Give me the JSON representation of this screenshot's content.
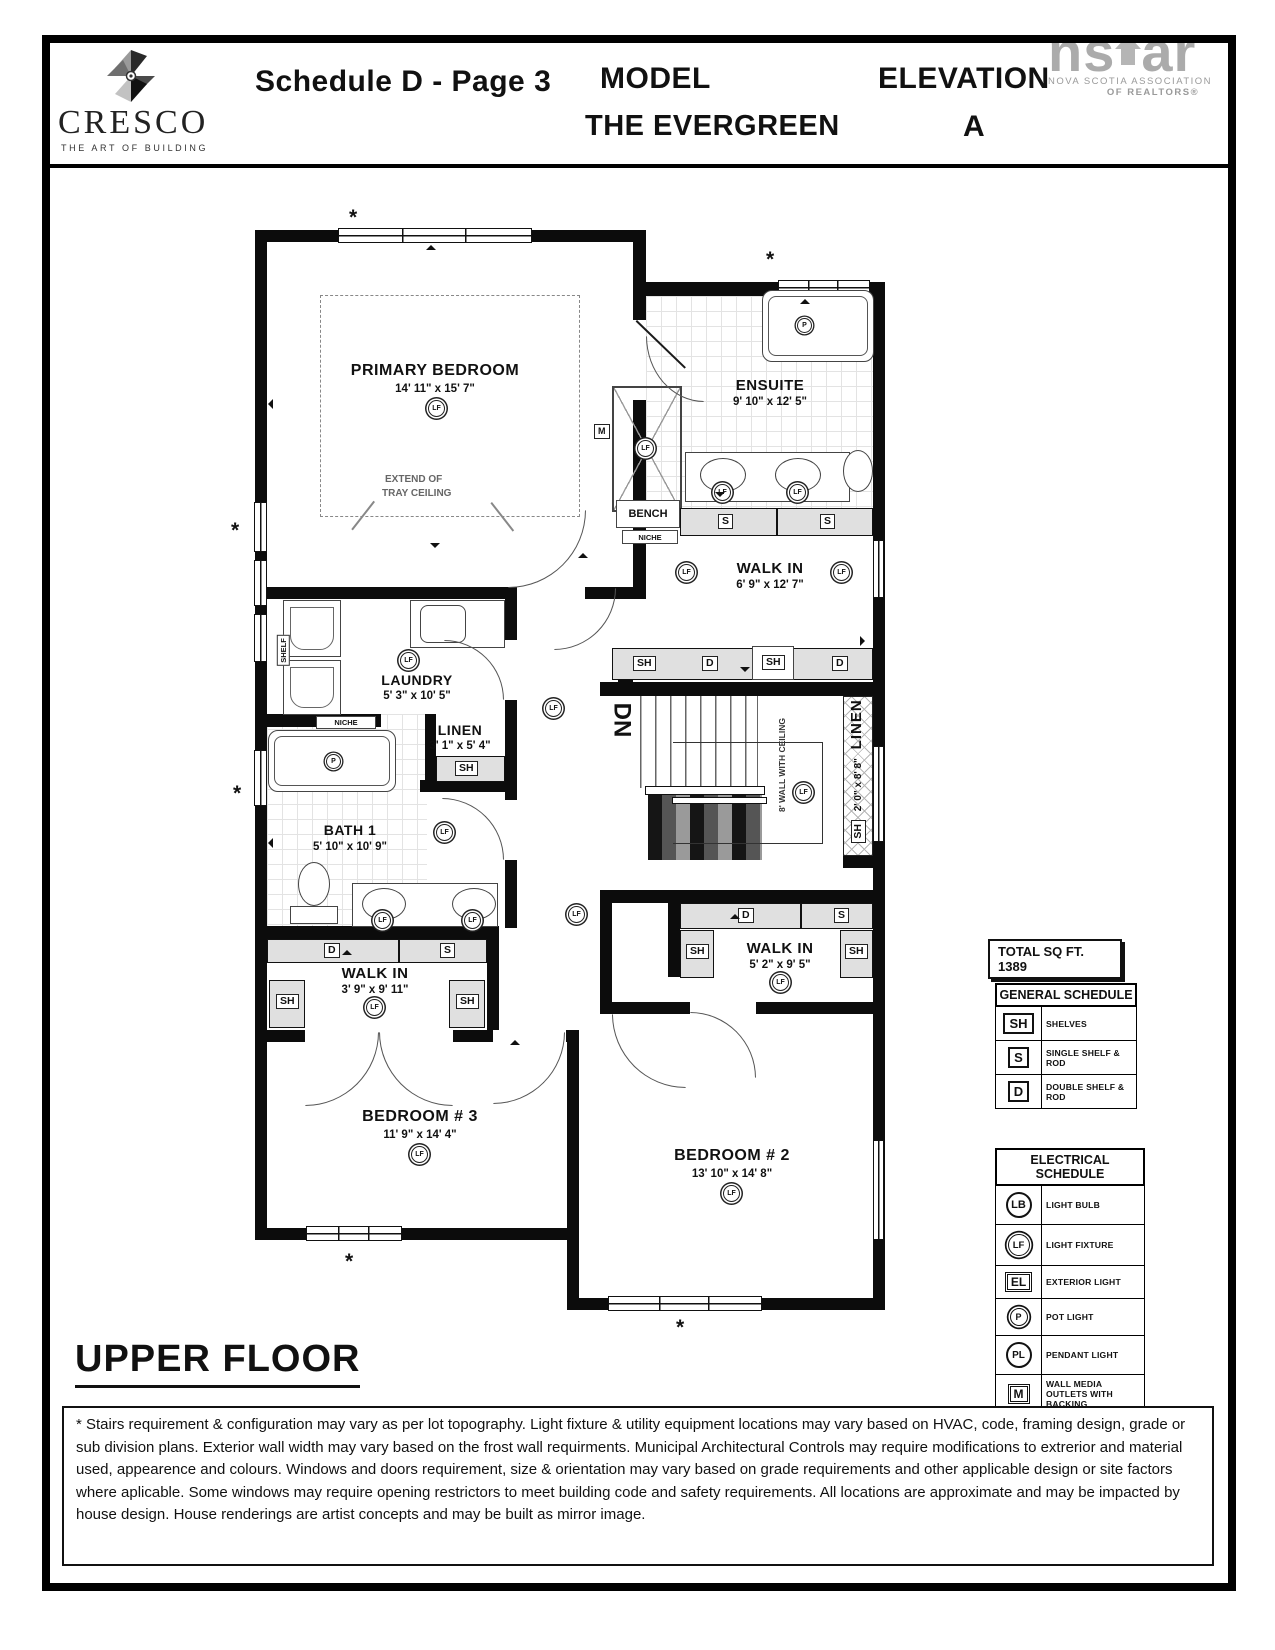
{
  "header": {
    "brand_name": "CRESCO",
    "brand_tagline": "THE ART OF BUILDING",
    "schedule_title": "Schedule D - Page 3",
    "model_label": "MODEL",
    "model_name": "THE EVERGREEN",
    "elevation_label": "ELEVATION",
    "elevation_value": "A",
    "nsar_ns": "ns",
    "nsar_ar": "ar",
    "nsar_line1": "NOVA SCOTIA ASSOCIATION",
    "nsar_line2": "OF REALTORS®"
  },
  "plan": {
    "floor_title": "UPPER FLOOR",
    "total_sqft": "TOTAL SQ FT. 1389",
    "asterisk": "*",
    "dn": "DN",
    "wall_note": "8' WALL WITH CEILING",
    "bench": "BENCH",
    "niche": "NICHE",
    "shelf": "SHELF",
    "tray_line1": "EXTEND OF",
    "tray_line2": "TRAY CEILING",
    "markers": {
      "sh": "SH",
      "s": "S",
      "d": "D",
      "m": "M",
      "lf": "LF",
      "p": "P"
    },
    "rooms": [
      {
        "name": "PRIMARY BEDROOM",
        "dims": "14' 11\" x 15' 7\""
      },
      {
        "name": "ENSUITE",
        "dims": "9' 10\" x 12' 5\""
      },
      {
        "name": "WALK IN",
        "dims": "6' 9\" x 12' 7\""
      },
      {
        "name": "LAUNDRY",
        "dims": "5' 3\" x 10' 5\""
      },
      {
        "name": "LINEN",
        "dims": "3' 1\" x 5' 4\""
      },
      {
        "name": "BATH 1",
        "dims": "5' 10\" x 10' 9\""
      },
      {
        "name": "WALK IN",
        "dims": "3' 9\" x 9' 11\""
      },
      {
        "name": "LINEN",
        "dims": "2' 0\" x 8' 8\""
      },
      {
        "name": "WALK IN",
        "dims": "5' 2\" x 9' 5\""
      },
      {
        "name": "BEDROOM # 3",
        "dims": "11' 9\" x 14' 4\""
      },
      {
        "name": "BEDROOM # 2",
        "dims": "13' 10\" x 14' 8\""
      }
    ]
  },
  "general_schedule": {
    "title": "GENERAL SCHEDULE",
    "rows": [
      {
        "symbol": "SH",
        "label": "SHELVES"
      },
      {
        "symbol": "S",
        "label": "SINGLE SHELF & ROD"
      },
      {
        "symbol": "D",
        "label": "DOUBLE SHELF & ROD"
      }
    ]
  },
  "electrical_schedule": {
    "title": "ELECTRICAL SCHEDULE",
    "rows": [
      {
        "symbol": "LB",
        "label": "LIGHT BULB"
      },
      {
        "symbol": "LF",
        "label": "LIGHT FIXTURE"
      },
      {
        "symbol": "EL",
        "label": "EXTERIOR LIGHT"
      },
      {
        "symbol": "P",
        "label": "POT LIGHT"
      },
      {
        "symbol": "PL",
        "label": "PENDANT LIGHT"
      },
      {
        "symbol": "M",
        "label": "WALL MEDIA OUTLETS WITH BACKING"
      },
      {
        "symbol": "U",
        "label": "UNDER CABINET LIGHT"
      }
    ]
  },
  "disclaimer": "* Stairs requirement & configuration may vary as per lot topography. Light fixture & utility equipment locations may vary based on HVAC, code, framing design, grade or sub division plans. Exterior wall width may vary based on the frost wall requirments. Municipal Architectural Controls may require modifications to extrerior and material used, appearence and colours. Windows and doors requirement, size & orientation may vary based on grade requirements and other applicable design or site factors where aplicable. Some windows may require opening restrictors to meet building code and safety requirements. All locations are approximate and may be impacted by house design. House renderings are artist concepts and may be built as mirror image."
}
